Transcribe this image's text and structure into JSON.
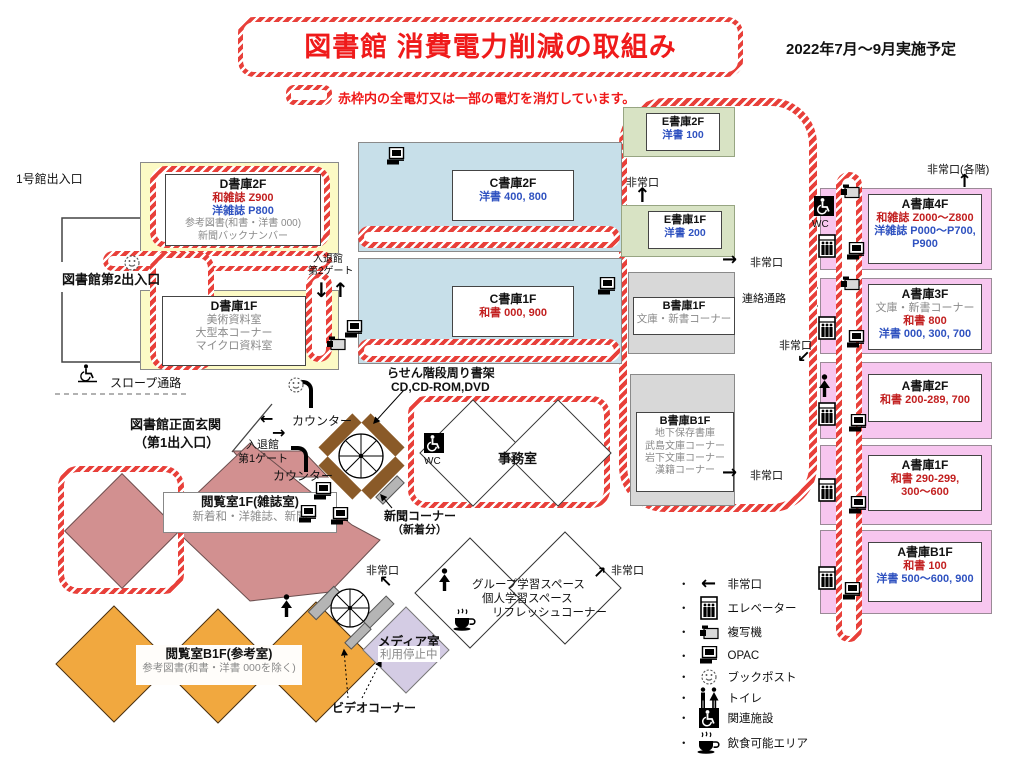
{
  "header": {
    "title": "図書館 消費電力削減の取組み",
    "period": "2022年7月～9月実施予定",
    "note": "赤枠内の全電灯又は一部の電灯を消灯しています。"
  },
  "stacks": {
    "d2f": {
      "name": "D書庫2F",
      "wa": "和雑誌 Z900",
      "yo": "洋雑誌 P800",
      "l3": "参考図書(和書・洋書 000)",
      "l4": "新聞バックナンバー"
    },
    "d1f": {
      "name": "D書庫1F",
      "l1": "美術資料室",
      "l2": "大型本コーナー",
      "l3": "マイクロ資料室"
    },
    "c2f": {
      "name": "C書庫2F",
      "yo": "洋書 400, 800"
    },
    "c1f": {
      "name": "C書庫1F",
      "wa": "和書 000, 900"
    },
    "e2f": {
      "name": "E書庫2F",
      "yo": "洋書 100"
    },
    "e1f": {
      "name": "E書庫1F",
      "yo": "洋書 200"
    },
    "b1f": {
      "name": "B書庫1F",
      "l1": "文庫・新書コーナー"
    },
    "bb1f": {
      "name": "B書庫B1F",
      "l1": "地下保存書庫",
      "l2": "武島文庫コーナー",
      "l3": "岩下文庫コーナー",
      "l4": "漢籍コーナー"
    },
    "a4f": {
      "name": "A書庫4F",
      "wa": "和雑誌 Z000～Z800",
      "yo": "洋雑誌 P000～P700,",
      "yo2": "P900"
    },
    "a3f": {
      "name": "A書庫3F",
      "l1": "文庫・新書コーナー",
      "wa": "和書 800",
      "yo": "洋書 000, 300, 700"
    },
    "a2f": {
      "name": "A書庫2F",
      "wa": "和書 200-289, 700"
    },
    "a1f": {
      "name": "A書庫1F",
      "wa": "和書 290-299,",
      "wa2": "300～600"
    },
    "ab1f": {
      "name": "A書庫B1F",
      "wa": "和書 100",
      "yo": "洋書 500～600, 900"
    }
  },
  "areas": {
    "reading1f": {
      "name": "閲覧室1F(雑誌室)",
      "desc": "新着和・洋雑誌、新聞"
    },
    "readingb1f": {
      "name": "閲覧室B1F(参考室)",
      "desc": "参考図書(和書・洋書 000を除く)"
    },
    "media": {
      "name": "メディア室",
      "status": "利用停止中"
    },
    "study": {
      "l1": "グループ学習スペース",
      "l2": "個人学習スペース",
      "l3": "リフレッシュコーナー"
    },
    "office": "事務室",
    "spiral1": {
      "l1": "らせん階段周り書架",
      "l2": "CD,CD-ROM,DVD"
    },
    "newspaper": {
      "l1": "新聞コーナー",
      "l2": "（新着分）"
    },
    "video": "ビデオコーナー"
  },
  "labels": {
    "entrance1": "1号館出入口",
    "entrance2": "図書館第2出入口",
    "slope": "スロープ通路",
    "main_entrance1": "図書館正面玄関",
    "main_entrance2": "（第1出入口）",
    "gate1a": "入退館",
    "gate1b": "第1ゲート",
    "gate2a": "入退館",
    "gate2b": "第2ゲート",
    "counter": "カウンター",
    "renraku": "連絡通路",
    "emergency": "非常口",
    "emergency_each": "非常口(各階)",
    "wc": "WC"
  },
  "legend": {
    "bullet": "・",
    "items": [
      {
        "label": "非常口",
        "icon": "arrow-left"
      },
      {
        "label": "エレベーター",
        "icon": "elevator"
      },
      {
        "label": "複写機",
        "icon": "copier"
      },
      {
        "label": "OPAC",
        "icon": "opac"
      },
      {
        "label": "ブックポスト",
        "icon": "smiley"
      },
      {
        "label": "トイレ",
        "icon": "toilet"
      },
      {
        "label": "関連施設",
        "icon": "wheelchair"
      },
      {
        "label": "飲食可能エリア",
        "icon": "cup"
      }
    ]
  },
  "colors": {
    "hatch_red": "#e8403a",
    "title_red": "#ef1a1a",
    "text_red": "#c22020",
    "text_blue": "#2f52c0",
    "text_gray": "#8a8a8a",
    "yellow": "#fcfac5",
    "blue": "#c7dfe9",
    "green": "#d8e3c4",
    "gray": "#d8d8d8",
    "pink": "#f7c6ef",
    "rose": "#d29090",
    "orange": "#f1a83f",
    "lavender": "#d4cce4",
    "brown": "#8a5a28"
  }
}
